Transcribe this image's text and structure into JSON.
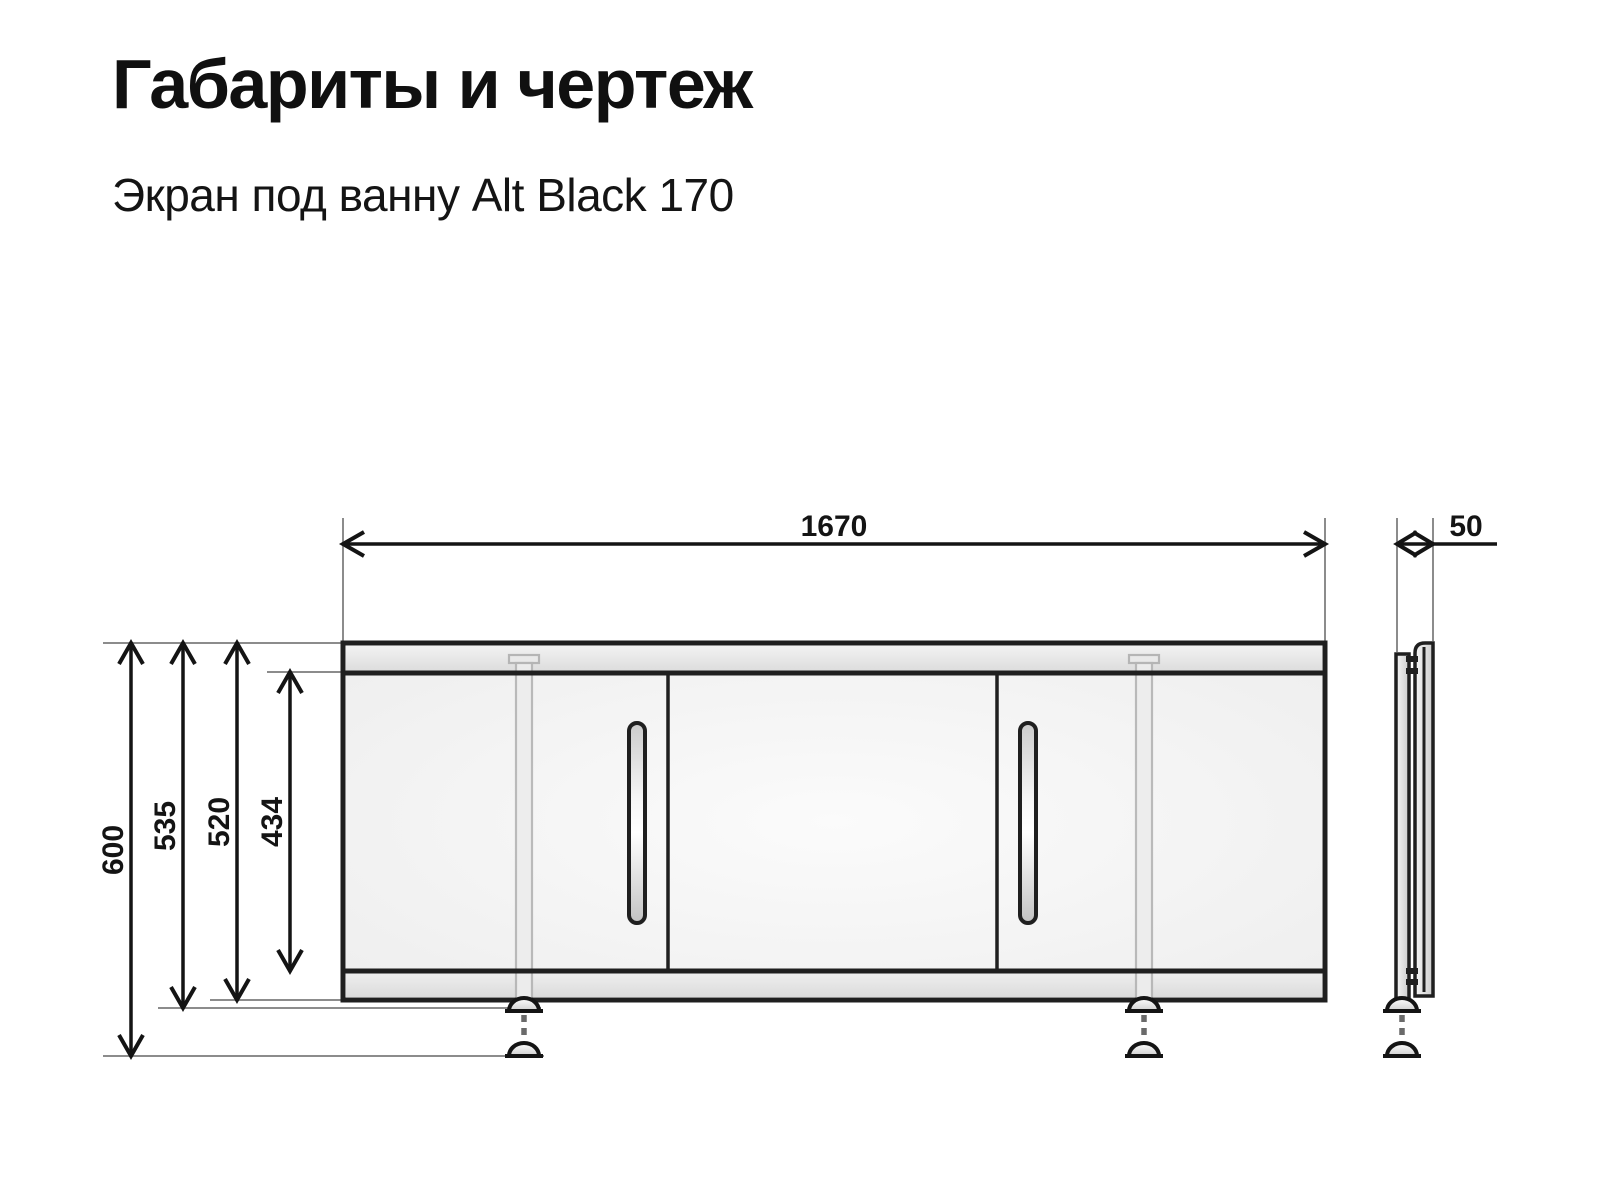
{
  "header": {
    "title": "Габариты и чертеж",
    "subtitle": "Экран под ванну Alt Black 170"
  },
  "drawing": {
    "product": "bath screen with three sliding doors, front view and side view",
    "dimensions": {
      "width": "1670",
      "depth": "50",
      "height_overall": "600",
      "height_feet_retracted": "535",
      "height_screen_body": "520",
      "door_height": "434"
    },
    "colors": {
      "outline": "#1f1f1f",
      "dimension_line": "#141414",
      "extension_line": "#8c8c8c",
      "door_fill": "#f3f3f3",
      "rail_fill": "#e4e4e4",
      "leg_gray": "#b5b5b5",
      "background": "#ffffff"
    }
  }
}
